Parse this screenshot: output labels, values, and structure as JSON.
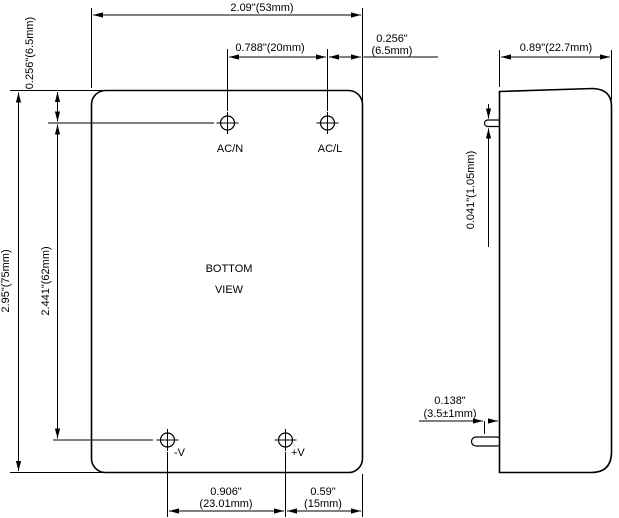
{
  "drawing_title": "power-module-dimension-drawing",
  "bottom_view": {
    "title": [
      "BOTTOM",
      "VIEW"
    ],
    "pin_labels": {
      "ac_n": "AC/N",
      "ac_l": "AC/L",
      "neg_v": "-V",
      "pos_v": "+V"
    },
    "dims": {
      "overall_width": "2.09\"(53mm)",
      "ac_pin_pitch": "0.788\"(20mm)",
      "ac_edge_offset": [
        "0.256\"",
        "(6.5mm)"
      ],
      "top_edge_offset": "0.256\"(6.5mm)",
      "overall_height": "2.95\"(75mm)",
      "pin_row_span": "2.441\"(62mm)",
      "dc_pin_pitch": [
        "0.906\"",
        "(23.01mm)"
      ],
      "dc_edge_offset": [
        "0.59\"",
        "(15mm)"
      ]
    }
  },
  "side_view": {
    "dims": {
      "overall_depth": "0.89\"(22.7mm)",
      "pin_thickness": "0.041\"(1.05mm)",
      "pin_protrusion": [
        "0.138\"",
        "(3.5±1mm)"
      ]
    }
  },
  "colors": {
    "line": "#000000",
    "background": "#ffffff"
  }
}
